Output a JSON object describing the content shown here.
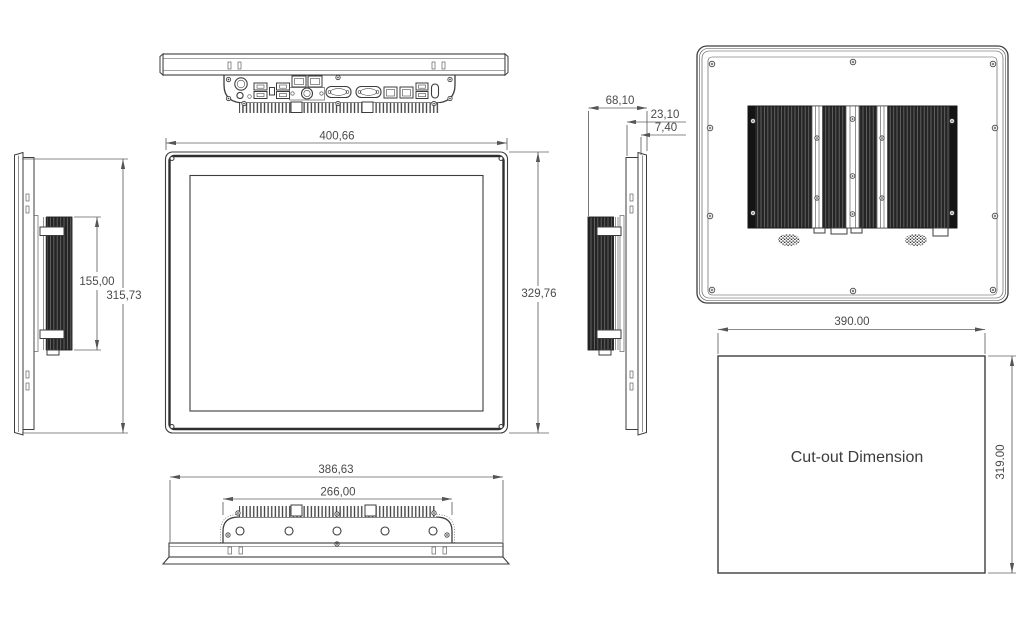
{
  "colors": {
    "background": "#ffffff",
    "object_line": "#3d3d3d",
    "dimension_line": "#606060",
    "label_text": "#4a4a4a",
    "heatsink_fill": "#242424"
  },
  "views": {
    "front": {
      "width": "400,66",
      "height": "329,76"
    },
    "left_side": {
      "heatsink_height": "155,00",
      "overall_height": "315,73"
    },
    "right_side": {
      "overall_depth": "68,10",
      "rear_section_depth": "23,10",
      "front_bezel_depth": "7,40"
    },
    "bottom": {
      "overall_width": "386,63",
      "heatsink_width": "266,00"
    },
    "cutout": {
      "width": "390.00",
      "height": "319.00",
      "label": "Cut-out Dimension"
    }
  }
}
